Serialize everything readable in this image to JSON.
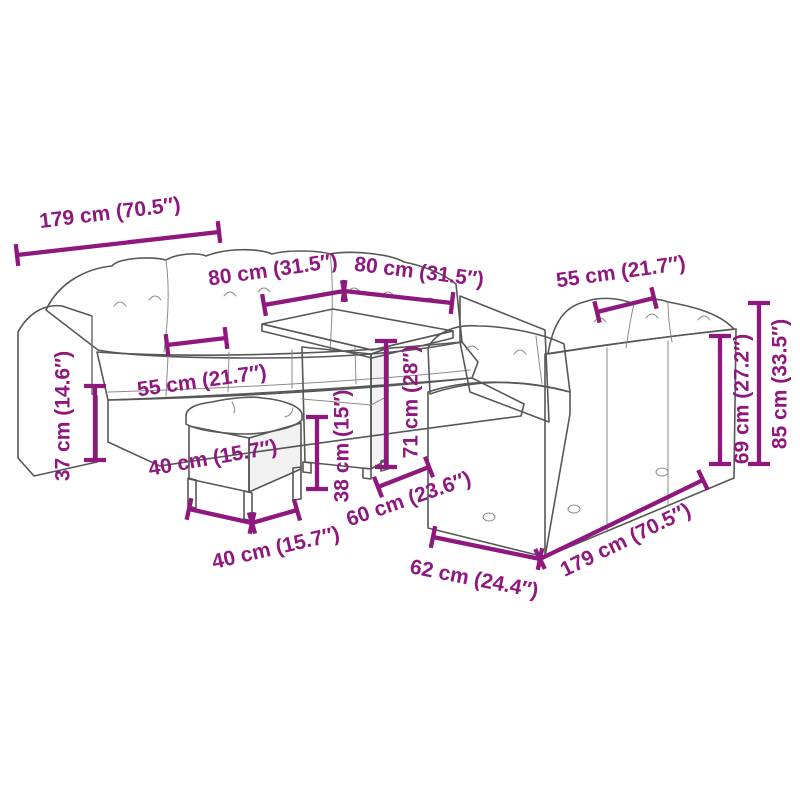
{
  "diagram": {
    "type": "product-dimension-diagram",
    "product": "rattan-garden-furniture-set",
    "accent_color": "#8e187e",
    "drawing_color": "#575757",
    "background_color": "#ffffff",
    "parts": [
      {
        "name": "left-sofa",
        "description": "three-seat sofa with cushions"
      },
      {
        "name": "square-table",
        "description": "square slat-top table with pedestal"
      },
      {
        "name": "stool",
        "description": "cushioned stool"
      },
      {
        "name": "right-corner-sofa",
        "description": "corner sofa seen from behind"
      }
    ],
    "dimensions": [
      {
        "name": "left-sofa-width",
        "label": "179 cm (70.5″)"
      },
      {
        "name": "table-depth",
        "label": "80 cm (31.5″)"
      },
      {
        "name": "table-width",
        "label": "80 cm (31.5″)"
      },
      {
        "name": "right-cushion-width",
        "label": "55 cm (21.7″)"
      },
      {
        "name": "back-height",
        "label": "69 cm (27.2″)"
      },
      {
        "name": "total-height",
        "label": "85 cm (33.5″)"
      },
      {
        "name": "seat-height",
        "label": "37 cm (14.6″)"
      },
      {
        "name": "left-cushion-width",
        "label": "55 cm (21.7″)"
      },
      {
        "name": "stool-depth",
        "label": "40 cm (15.7″)"
      },
      {
        "name": "stool-width",
        "label": "40 cm (15.7″)"
      },
      {
        "name": "stool-height",
        "label": "38 cm (15″)"
      },
      {
        "name": "table-height",
        "label": "71 cm (28″)"
      },
      {
        "name": "seat-depth",
        "label": "60 cm (23.6″)"
      },
      {
        "name": "right-sofa-depth",
        "label": "62 cm (24.4″)"
      },
      {
        "name": "right-sofa-width",
        "label": "179 cm (70.5″)"
      }
    ]
  }
}
